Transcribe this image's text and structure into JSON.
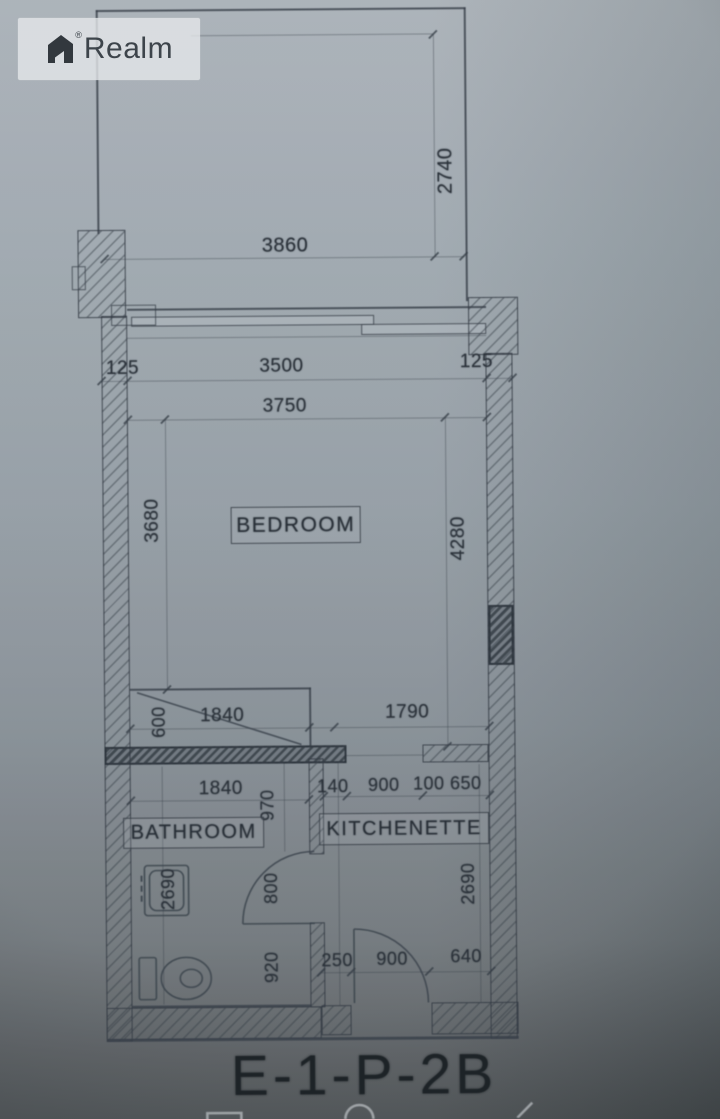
{
  "watermark": {
    "brand": "Realm",
    "registered": "®"
  },
  "plan": {
    "title": "E-1-P-2B",
    "rooms": {
      "bedroom": "BEDROOM",
      "bathroom": "BATHROOM",
      "kitchenette": "KITCHENETTE"
    },
    "dims": {
      "terrace_w": "3860",
      "terrace_d": "2740",
      "offset_l": "125",
      "win_w": "3500",
      "offset_r": "125",
      "bed_w": "3750",
      "bed_h_left": "3680",
      "bed_h_right": "4280",
      "closet_d": "600",
      "closet_w": "1840",
      "south_right_w": "1790",
      "bath_w": "1840",
      "hall_d": "970",
      "kit_seg_a": "140",
      "kit_door_w": "900",
      "kit_seg_b": "100",
      "kit_seg_c": "650",
      "bath_h": "2690",
      "bath_door_w": "800",
      "kit_h": "2690",
      "bath_d": "920",
      "bot_seg_a": "250",
      "bot_door_w": "900",
      "bot_seg_b": "640"
    },
    "colors": {
      "paper": "#8f99a3",
      "line": "#39414a",
      "ink": "#272e36"
    }
  }
}
